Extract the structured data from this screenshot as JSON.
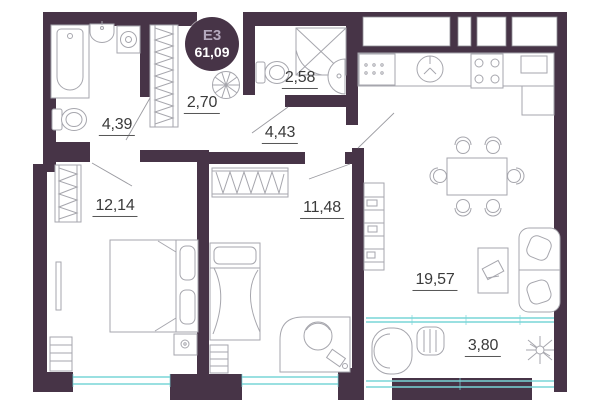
{
  "plan": {
    "badge": {
      "code": "E3",
      "total_area": "61,09"
    },
    "rooms": [
      {
        "name": "bathroom",
        "area": "4,39"
      },
      {
        "name": "hall-closet",
        "area": "2,70"
      },
      {
        "name": "wc-shower",
        "area": "2,58"
      },
      {
        "name": "corridor",
        "area": "4,43"
      },
      {
        "name": "bedroom-1",
        "area": "12,14"
      },
      {
        "name": "bedroom-2",
        "area": "11,48"
      },
      {
        "name": "kitchen-living",
        "area": "19,57"
      },
      {
        "name": "balcony",
        "area": "3,80"
      }
    ],
    "colors": {
      "wall": "#473447",
      "glazing": "#79d5d7",
      "furniture_line": "#a6a6ad",
      "label_text": "#3b3b3b",
      "badge_code_text": "#b4a8bd",
      "badge_area_text": "#ffffff"
    },
    "icons": [
      "bathtub-icon",
      "sink-icon",
      "washing-machine-icon",
      "toilet-icon",
      "shower-icon",
      "wardrobe-icon",
      "fan-icon",
      "double-bed-icon",
      "single-bed-icon",
      "tv-icon",
      "dresser-icon",
      "desk-icon",
      "chair-icon",
      "kitchen-sink-icon",
      "stove-icon",
      "dining-table-icon",
      "sofa-icon",
      "bookshelf-icon",
      "tv-stand-icon",
      "armchair-icon",
      "plant-icon"
    ]
  }
}
